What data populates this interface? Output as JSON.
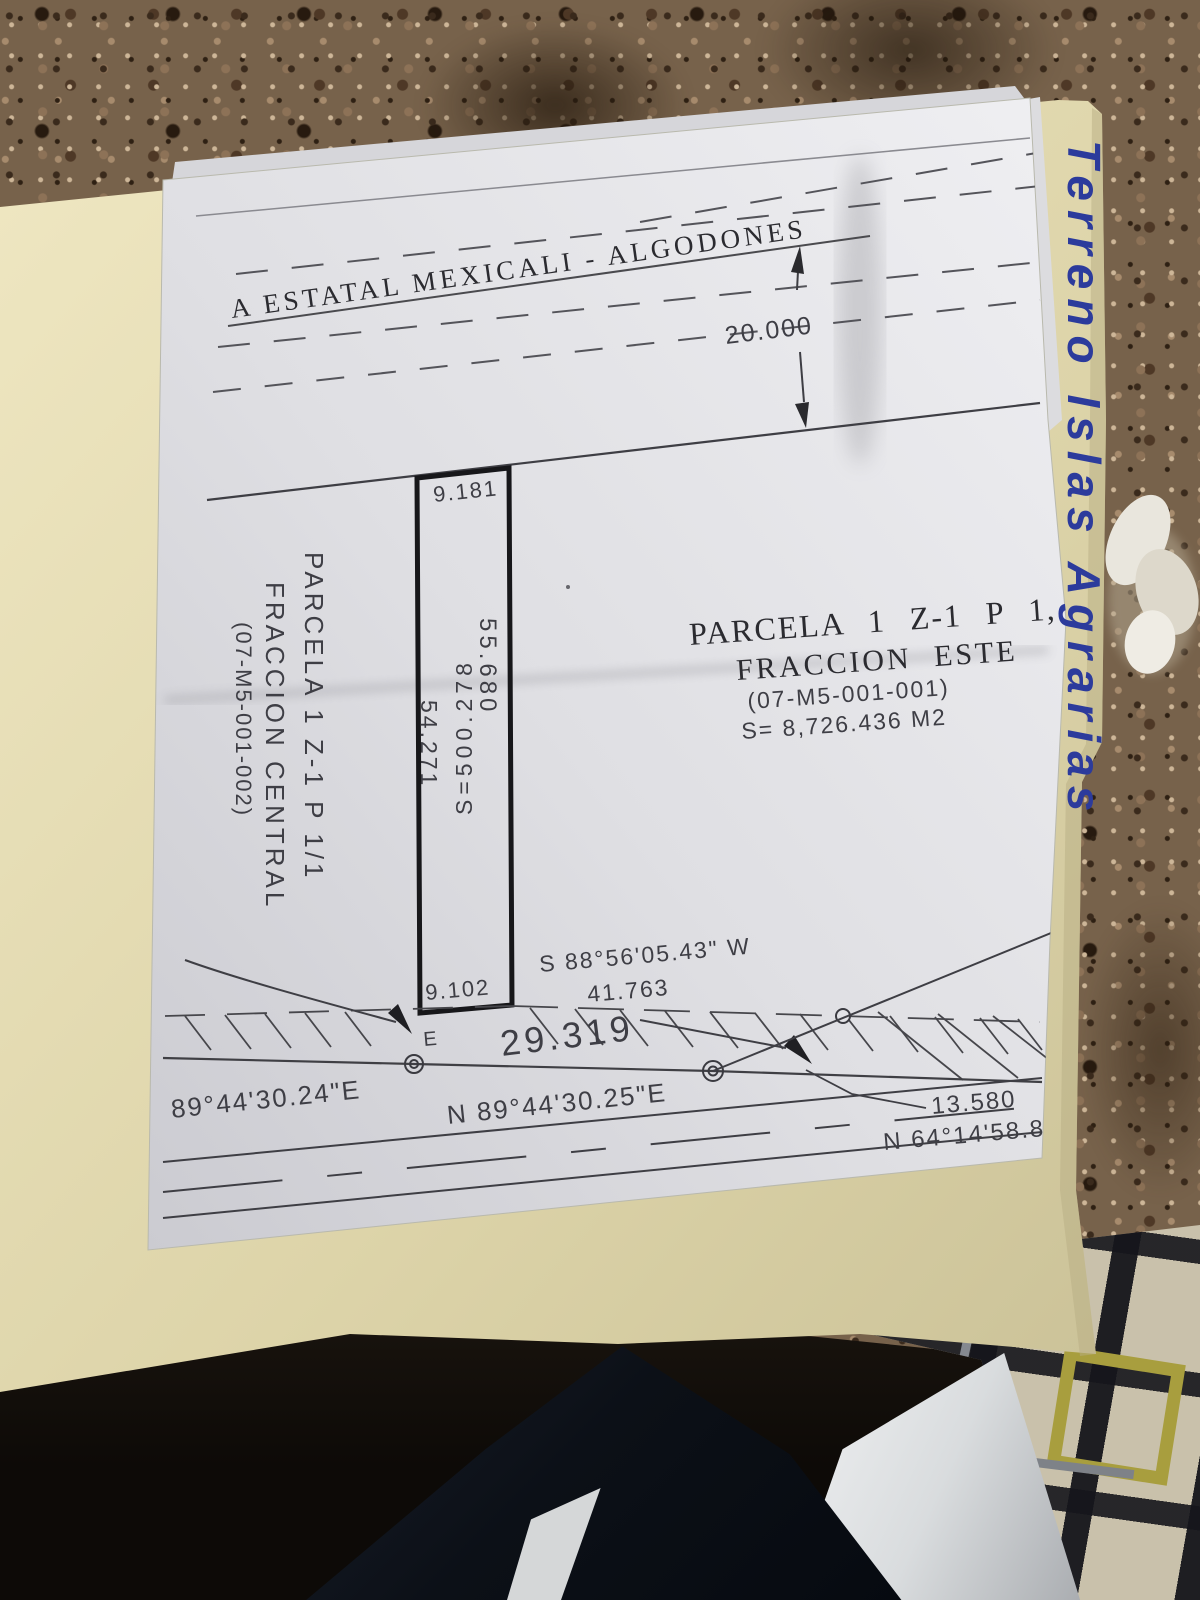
{
  "handwriting": {
    "text": "Terreno Islas Agrarias",
    "color": "#2c3b9c"
  },
  "plan": {
    "road_label": "A ESTATAL MEXICALI - ALGODONES",
    "road_width": "20.000",
    "strip_top": "9.181",
    "strip_bottom": "9.102",
    "strip_side_east": "55.680",
    "strip_area": "S=500.278",
    "strip_side_west": "54.271",
    "neighbor": [
      "PARCELA 1 Z-1 P 1/1",
      "FRACCION CENTRAL",
      "(07-M5-001-002)"
    ],
    "title": [
      "PARCELA 1 Z-1 P 1,",
      "FRACCION ESTE",
      "(07-M5-001-001)",
      "S= 8,726.436 M2"
    ],
    "bearing_south": "S 88°56'05.43\" W",
    "dist_south": "41.763",
    "point_e": "E",
    "dist_29": "29.319",
    "bearing_a": "89°44'30.24\"E",
    "bearing_b": "N 89°44'30.25\"E",
    "dist_13": "13.580",
    "bearing_c": "N 64°14'58.85"
  }
}
